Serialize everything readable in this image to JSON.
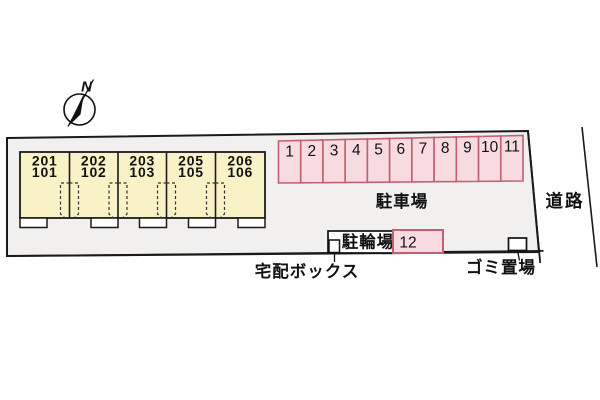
{
  "compass": {
    "label": "N"
  },
  "site": {
    "fill": "#f1f0ee",
    "outline_color": "#1a1a1a"
  },
  "building": {
    "fill": "#f8f2c6",
    "units": [
      {
        "upper": "201",
        "lower": "101"
      },
      {
        "upper": "202",
        "lower": "102"
      },
      {
        "upper": "203",
        "lower": "103"
      },
      {
        "upper": "205",
        "lower": "105"
      },
      {
        "upper": "206",
        "lower": "106"
      }
    ]
  },
  "parking": {
    "label": "駐車場",
    "fill": "#f8dbe0",
    "border": "#c2606f",
    "spaces": [
      "1",
      "2",
      "3",
      "4",
      "5",
      "6",
      "7",
      "8",
      "9",
      "10",
      "11"
    ],
    "extra_space": "12"
  },
  "bicycle": {
    "label": "駐輪場"
  },
  "delivery_box": {
    "label": "宅配ボックス"
  },
  "garbage": {
    "label": "ゴミ置場"
  },
  "road": {
    "label": "道路"
  }
}
